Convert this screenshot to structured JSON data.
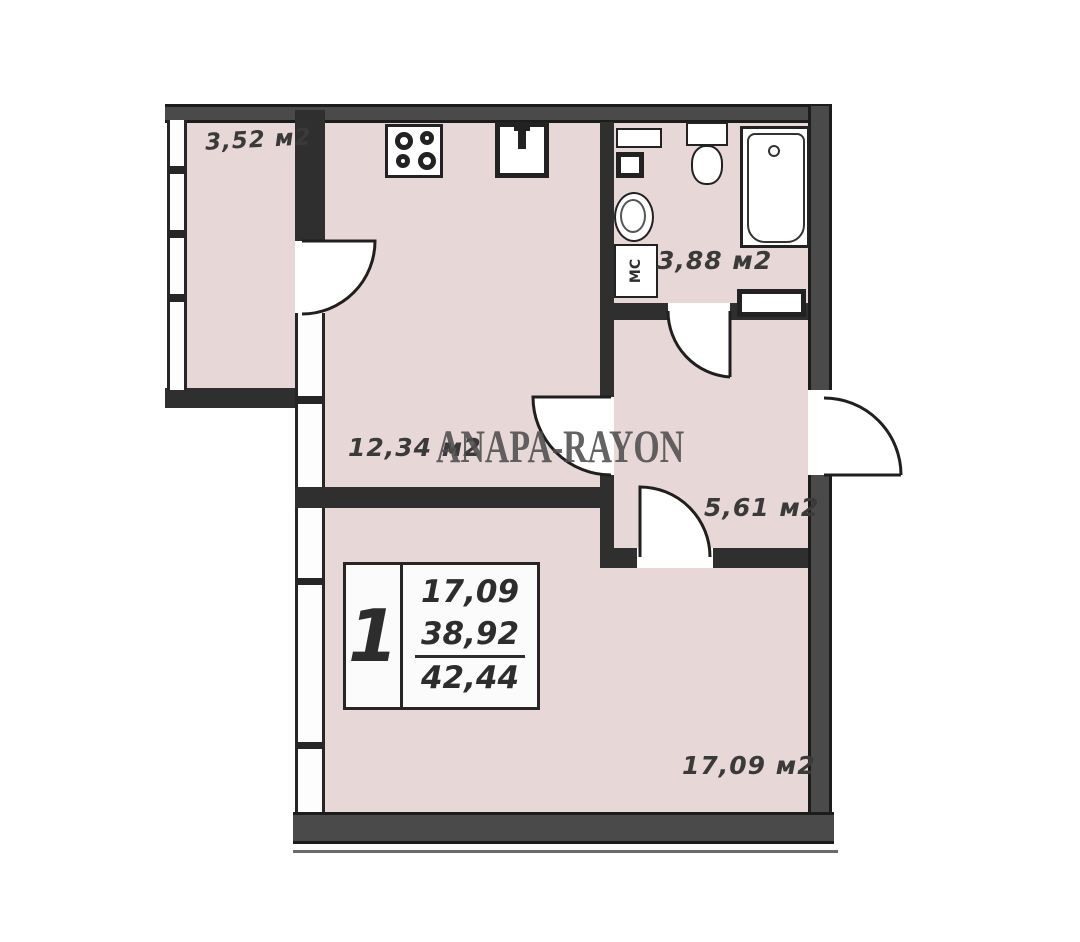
{
  "watermark": "ANAPA-RAYON",
  "rooms": {
    "balcony": {
      "name": "balcony",
      "area": "3,52 м2"
    },
    "kitchen": {
      "name": "kitchen",
      "area": "12,34 м2"
    },
    "bathroom": {
      "name": "bathroom",
      "area": "3,88 м2",
      "washing_machine_label": "МС"
    },
    "hallway": {
      "name": "hallway",
      "area": "5,61 м2"
    },
    "living_room": {
      "name": "living room",
      "area": "17,09 м2"
    }
  },
  "stamp": {
    "rooms_count": "1",
    "living_area": "17,09",
    "area_without_balcony": "38,92",
    "total_area": "42,44"
  },
  "colors": {
    "floor": "#e8d7d7",
    "wall_dark": "#2f2f2f",
    "wall_exterior": "#4a4a4a",
    "watermark": "#4e4e4e"
  }
}
